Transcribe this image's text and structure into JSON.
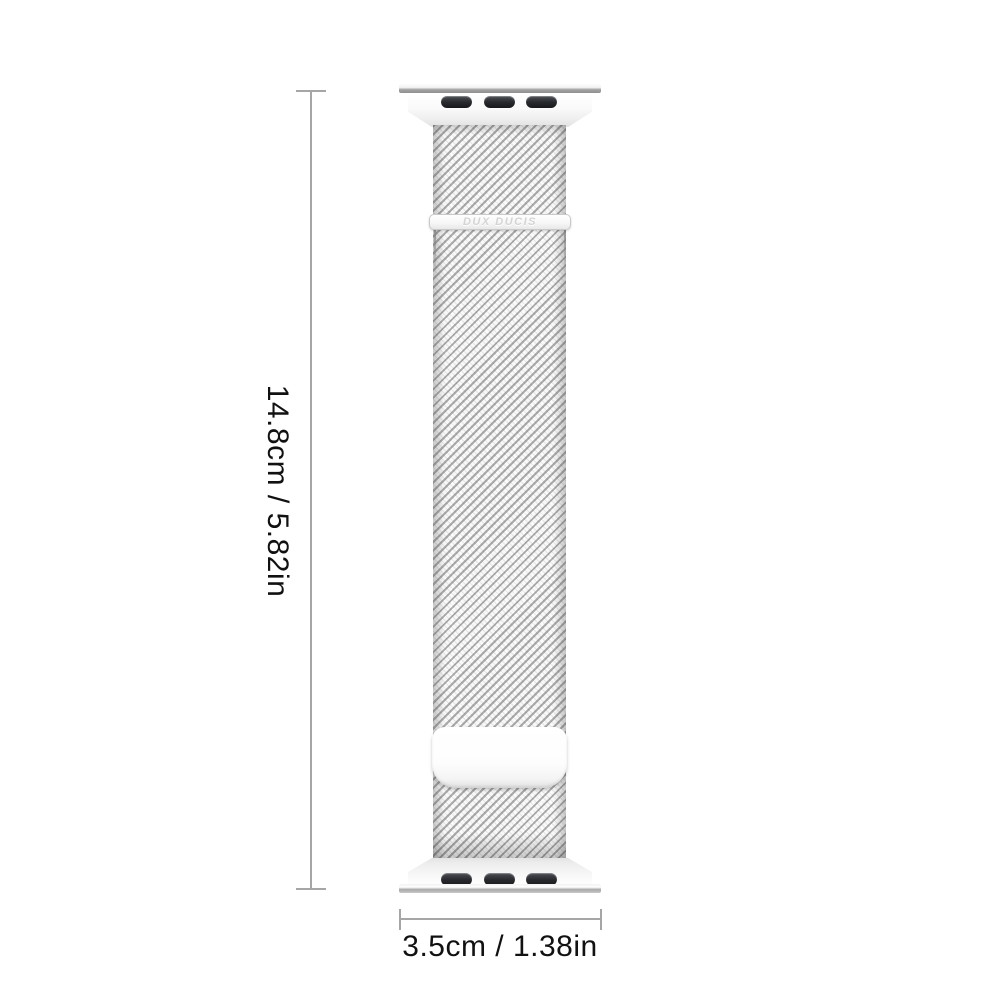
{
  "image_type": "product-dimension-diagram",
  "product": {
    "brand_engraving": "DUX DUCIS"
  },
  "dimensions": {
    "height_label": "14.8cm / 5.82in",
    "width_label": "3.5cm / 1.38in"
  },
  "colors": {
    "background": "#ffffff",
    "dimension_line": "#a6a6a6",
    "dimension_text": "#111111",
    "mesh_stripe_gray": "#8f8f8f",
    "hardware_white": "#fbfbfb",
    "slot_dark": "#26282c",
    "engraving_text": "#d4d4d4"
  }
}
